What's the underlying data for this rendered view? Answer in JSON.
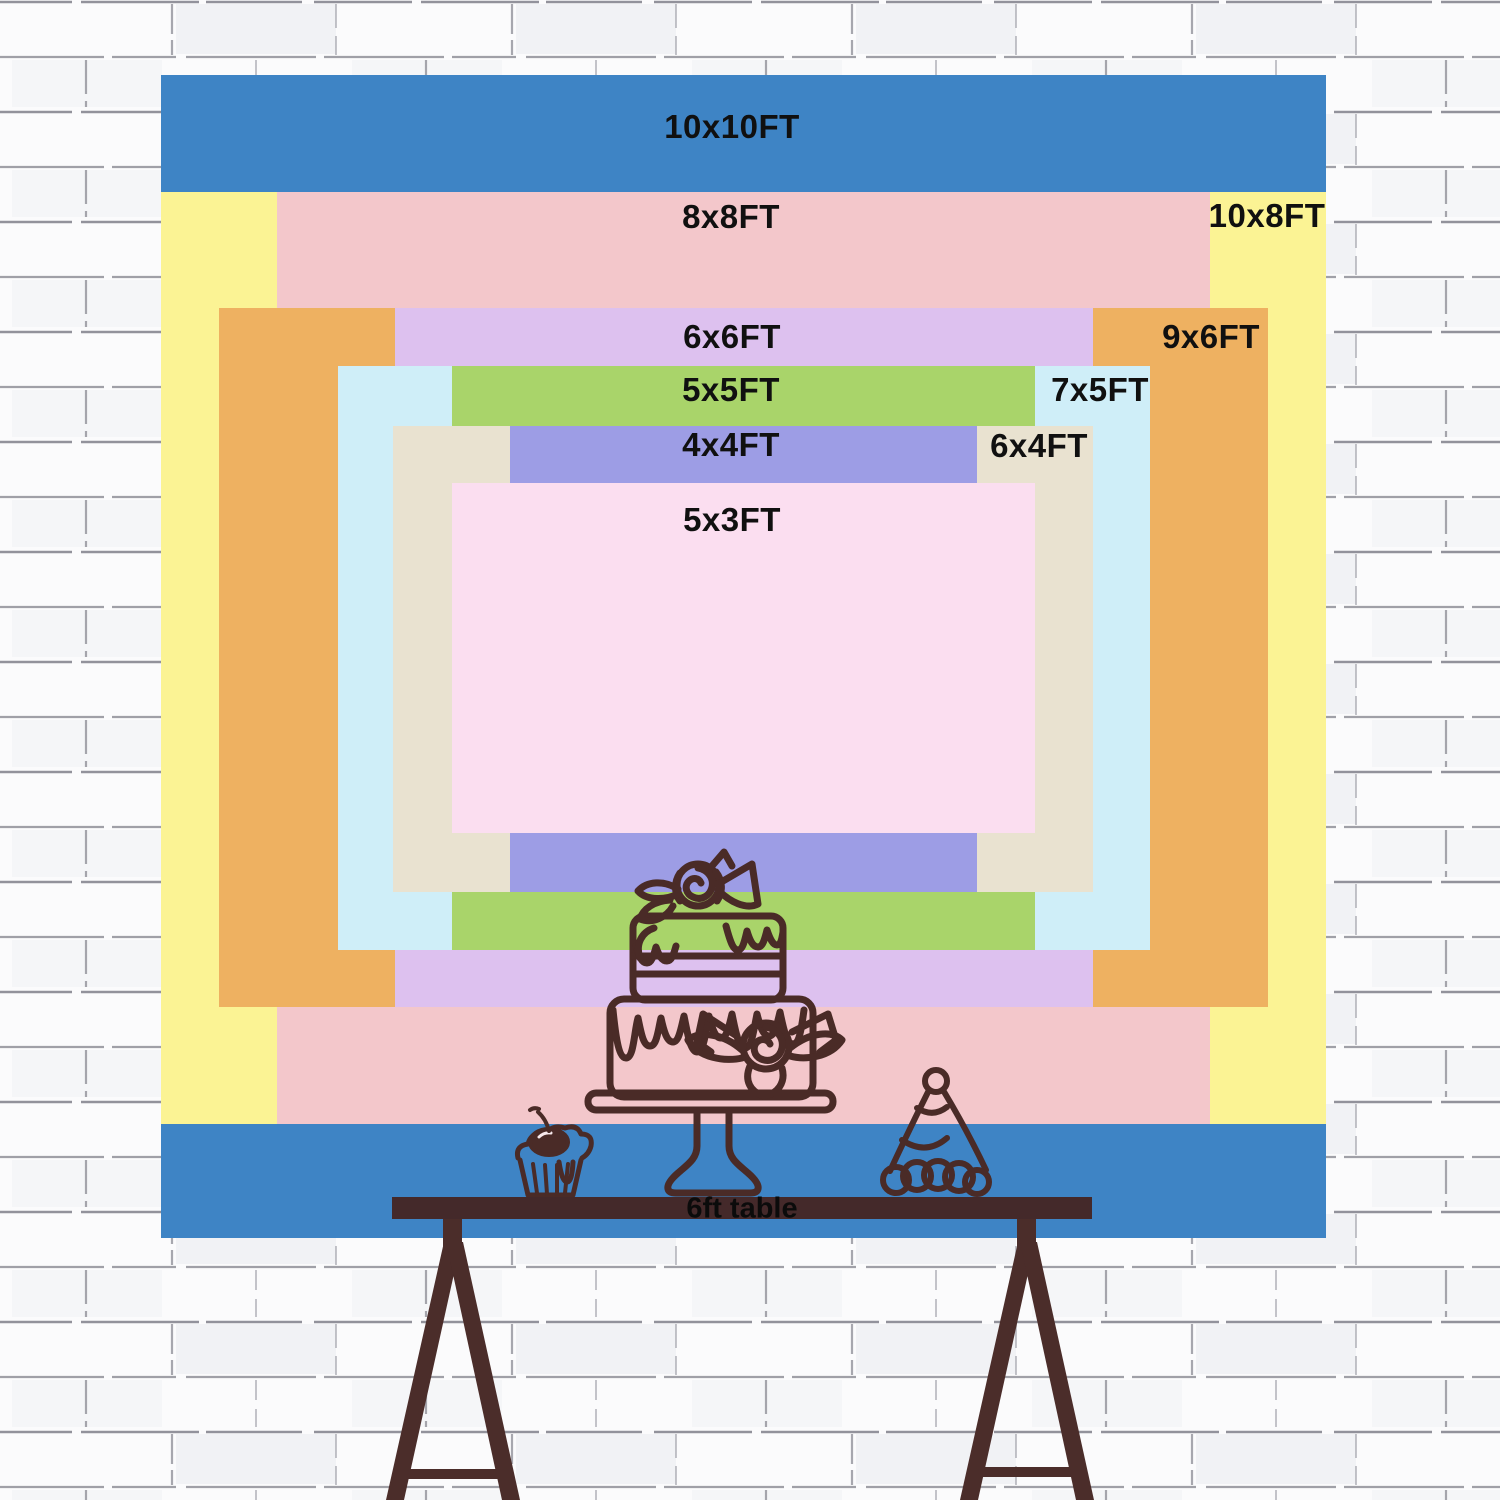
{
  "backdrop": {
    "description": "backdrop size chart",
    "sizes": [
      {
        "id": "10x10",
        "label": "10x10FT",
        "width_ft": 10,
        "height_ft": 10,
        "color": "#3e84c5"
      },
      {
        "id": "10x8",
        "label": "10x8FT",
        "width_ft": 10,
        "height_ft": 8,
        "color": "#fbf394"
      },
      {
        "id": "8x8",
        "label": "8x8FT",
        "width_ft": 8,
        "height_ft": 8,
        "color": "#f3c7cb"
      },
      {
        "id": "9x6",
        "label": "9x6FT",
        "width_ft": 9,
        "height_ft": 6,
        "color": "#eeb161"
      },
      {
        "id": "6x6",
        "label": "6x6FT",
        "width_ft": 6,
        "height_ft": 6,
        "color": "#ddc1ef"
      },
      {
        "id": "7x5",
        "label": "7x5FT",
        "width_ft": 7,
        "height_ft": 5,
        "color": "#cfeef8"
      },
      {
        "id": "5x5",
        "label": "5x5FT",
        "width_ft": 5,
        "height_ft": 5,
        "color": "#a9d46a"
      },
      {
        "id": "6x4",
        "label": "6x4FT",
        "width_ft": 6,
        "height_ft": 4,
        "color": "#e9e2d0"
      },
      {
        "id": "4x4",
        "label": "4x4FT",
        "width_ft": 4,
        "height_ft": 4,
        "color": "#9d9de5"
      },
      {
        "id": "5x3",
        "label": "5x3FT",
        "width_ft": 5,
        "height_ft": 3,
        "color": "#fbdef0"
      }
    ],
    "label_color": "#101010"
  },
  "table": {
    "label": "6ft table",
    "surface_color": "#44292a",
    "easel_color": "#4b2d2a",
    "label_color": "#0b0b0b"
  },
  "illustration": {
    "line_color": "#4a2b27",
    "items": [
      "tiered-cake-with-roses",
      "cupcake-with-cherry",
      "party-hat"
    ]
  },
  "wall": {
    "brick_color": "#fbfbfc",
    "mortar_color": "#6f6f7a"
  }
}
